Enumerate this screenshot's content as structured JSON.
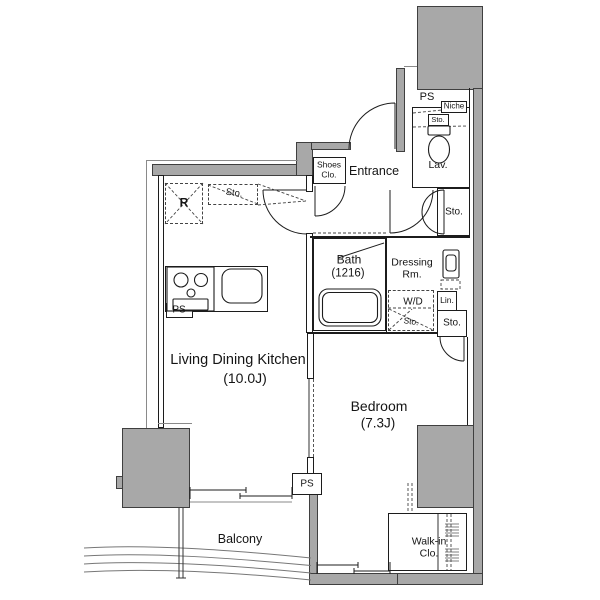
{
  "colors": {
    "wall_fill": "#a8a8a8",
    "wall_border": "#3f3f3f",
    "line": "#1c1c1c",
    "text": "#151515",
    "background": "#ffffff"
  },
  "rooms": {
    "ldk": {
      "name": "Living Dining Kitchen",
      "size": "(10.0J)"
    },
    "bedroom": {
      "name": "Bedroom",
      "size": "(7.3J)"
    },
    "bath": {
      "name": "Bath",
      "size": "(1216)"
    },
    "entrance": {
      "name": "Entrance"
    },
    "lavatory": {
      "name": "Lav."
    },
    "dressing_room": {
      "line1": "Dressing",
      "line2": "Rm."
    },
    "balcony": {
      "name": "Balcony"
    },
    "walk_in_closet": {
      "line1": "Walk-in",
      "line2": "Clo."
    },
    "shoes_closet": {
      "line1": "Shoes",
      "line2": "Clo."
    }
  },
  "fixtures": {
    "refrigerator": "R",
    "washer_dryer": "W/D",
    "niche": "Niche",
    "linen": "Lin."
  },
  "shafts": {
    "ps_top": "PS",
    "ps_kitchen": "PS",
    "ps_bottom": "PS"
  },
  "storage": {
    "kitchen": "Sto.",
    "toilet": "Sto.",
    "hall": "Sto.",
    "laundry": "Sto.",
    "bedroom": "Sto."
  }
}
